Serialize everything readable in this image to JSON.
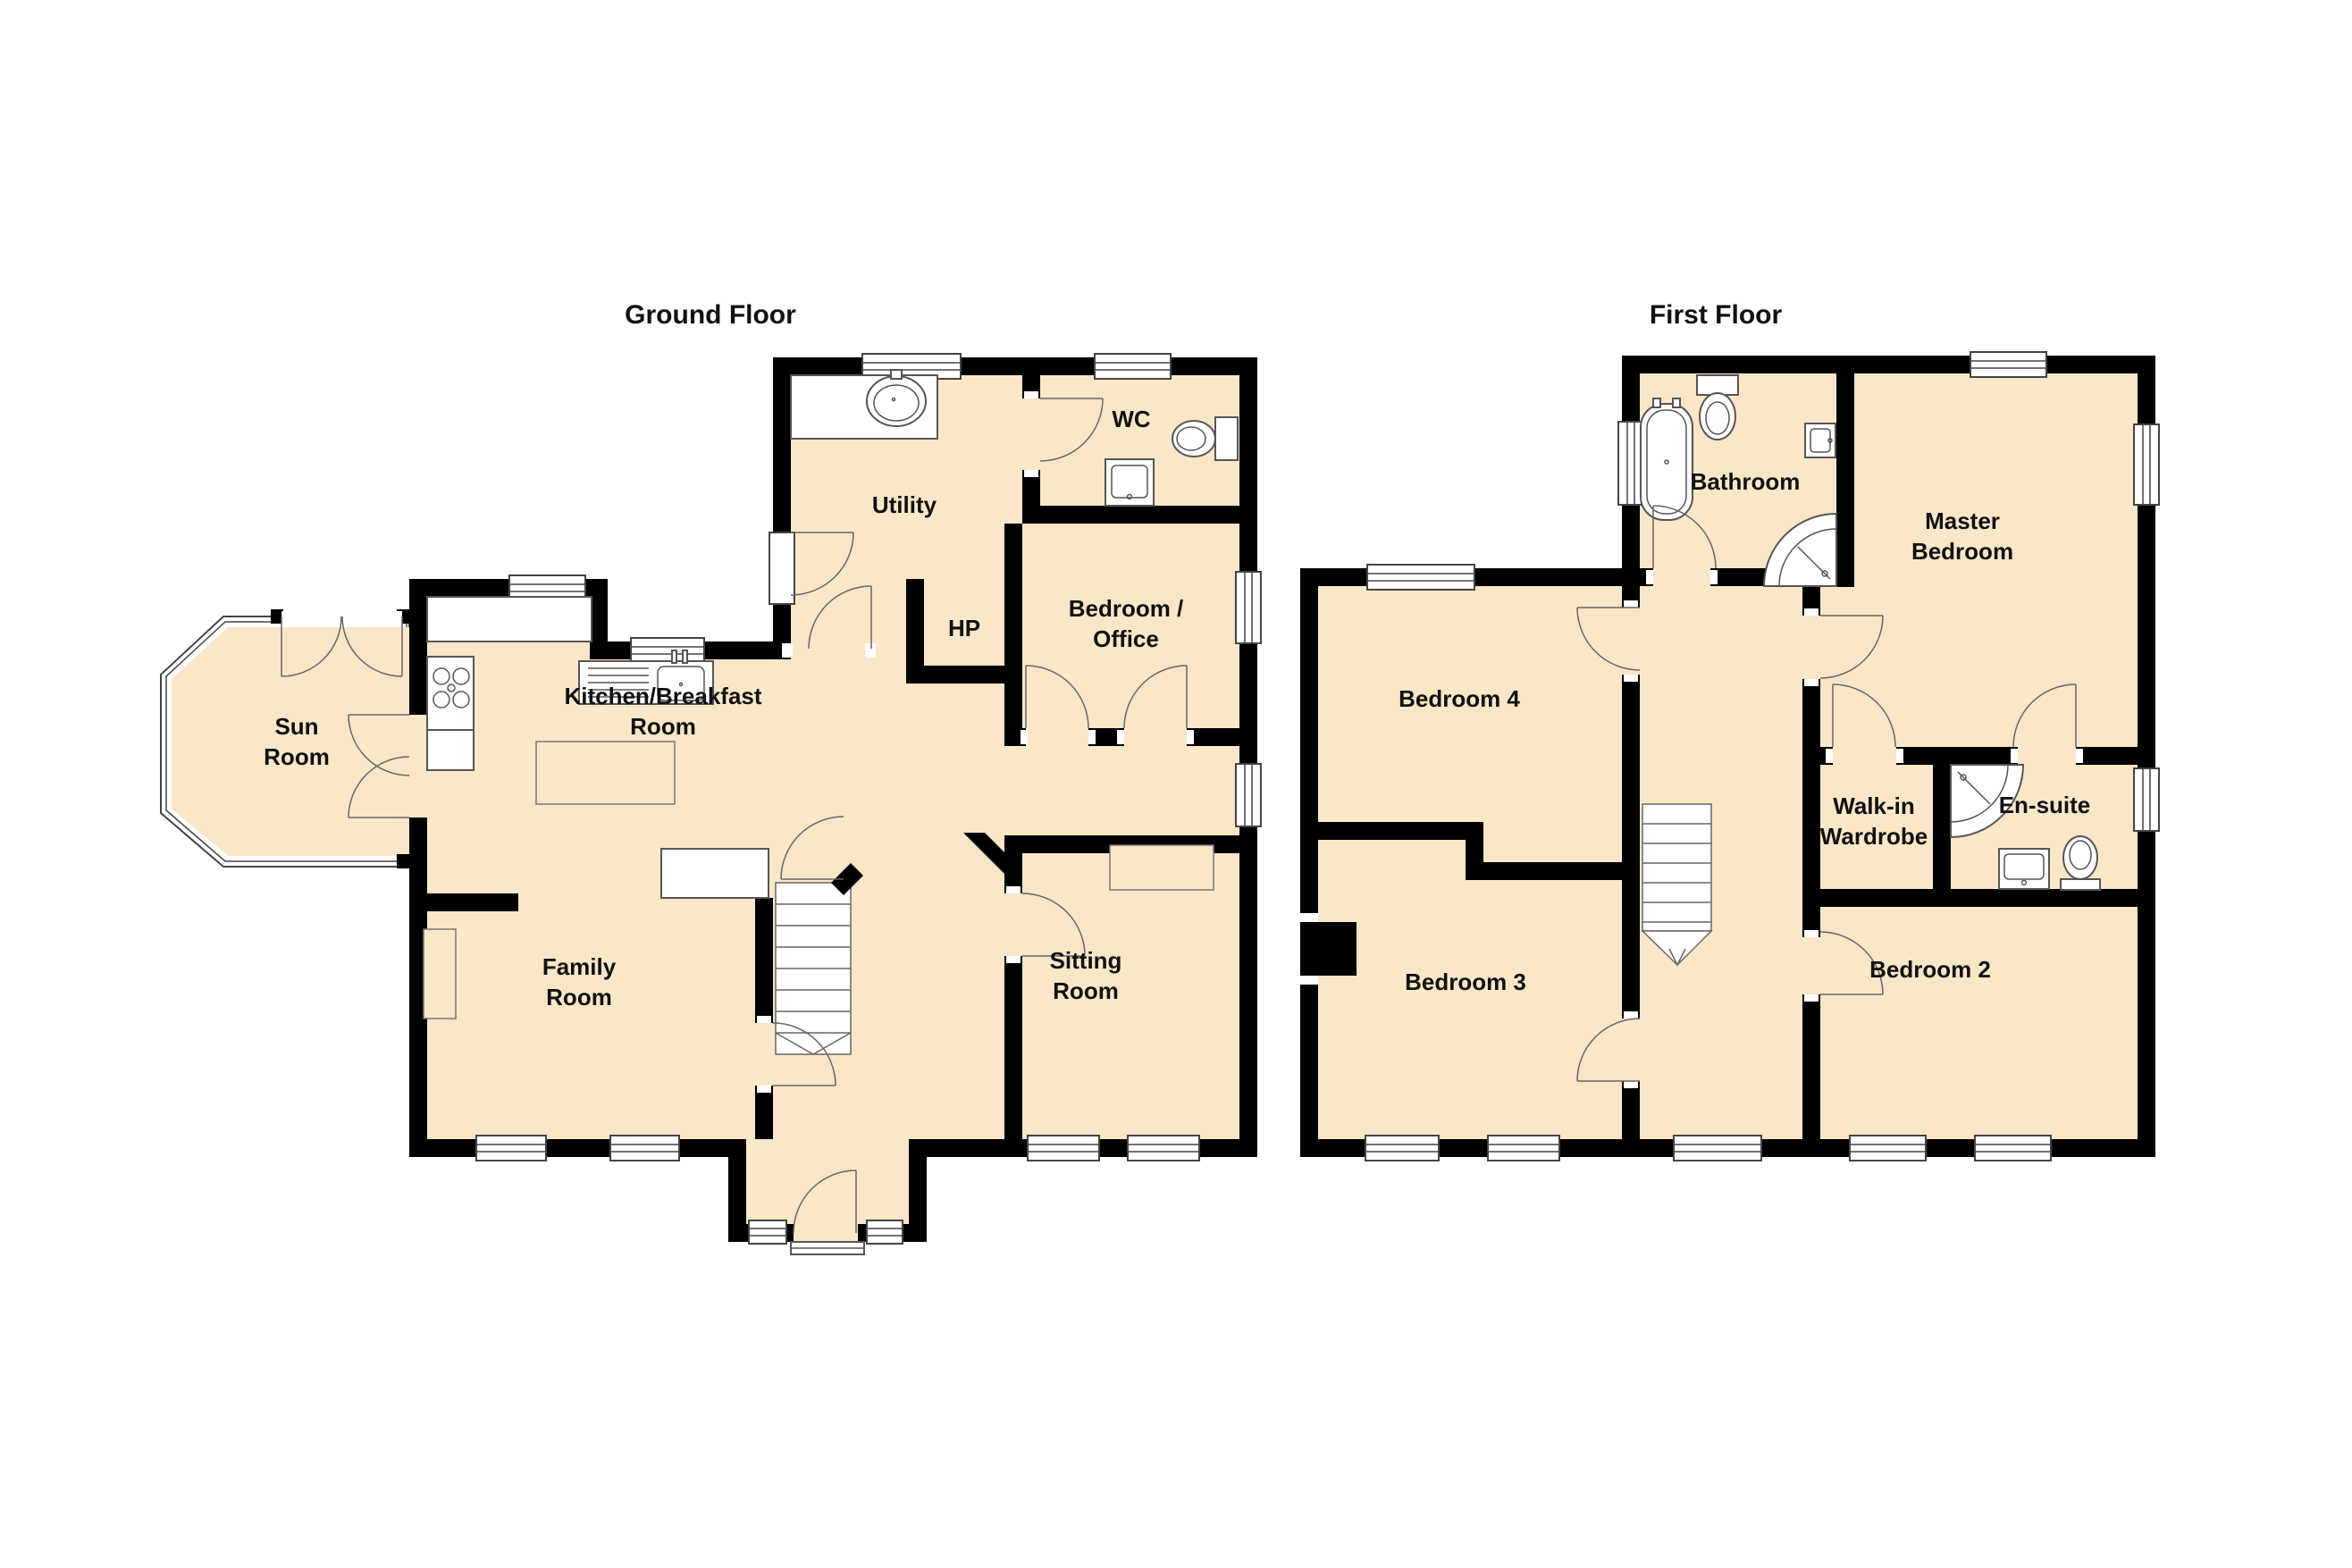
{
  "ground_floor": {
    "title": "Ground Floor",
    "rooms": {
      "sun_room": {
        "label": "Sun Room",
        "lines": [
          "Sun",
          "Room"
        ]
      },
      "kitchen_breakfast_room": {
        "label": "Kitchen/Breakfast Room",
        "lines": [
          "Kitchen/Breakfast",
          "Room"
        ]
      },
      "utility": {
        "label": "Utility",
        "lines": [
          "Utility"
        ]
      },
      "wc": {
        "label": "WC",
        "lines": [
          "WC"
        ]
      },
      "hp": {
        "label": "HP",
        "lines": [
          "HP"
        ]
      },
      "bedroom_office": {
        "label": "Bedroom / Office",
        "lines": [
          "Bedroom /",
          "Office"
        ]
      },
      "family_room": {
        "label": "Family Room",
        "lines": [
          "Family",
          "Room"
        ]
      },
      "sitting_room": {
        "label": "Sitting Room",
        "lines": [
          "Sitting",
          "Room"
        ]
      }
    }
  },
  "first_floor": {
    "title": "First Floor",
    "rooms": {
      "bathroom": {
        "label": "Bathroom",
        "lines": [
          "Bathroom"
        ]
      },
      "master_bedroom": {
        "label": "Master Bedroom",
        "lines": [
          "Master",
          "Bedroom"
        ]
      },
      "bedroom_4": {
        "label": "Bedroom 4",
        "lines": [
          "Bedroom 4"
        ]
      },
      "walk_in_wardrobe": {
        "label": "Walk-in Wardrobe",
        "lines": [
          "Walk-in",
          "Wardrobe"
        ]
      },
      "en_suite": {
        "label": "En-suite",
        "lines": [
          "En-suite"
        ]
      },
      "bedroom_3": {
        "label": "Bedroom 3",
        "lines": [
          "Bedroom 3"
        ]
      },
      "bedroom_2": {
        "label": "Bedroom 2",
        "lines": [
          "Bedroom 2"
        ]
      }
    }
  },
  "fixtures": {
    "ground": [
      "utility-sink",
      "wc-toilet",
      "wc-basin",
      "kitchen-sink",
      "stove-hob",
      "kitchen-island",
      "kitchen-peninsula",
      "staircase",
      "fireplace",
      "chimney-breast",
      "front-door-step",
      "bay-window",
      "french-doors"
    ],
    "first": [
      "bathtub",
      "toilet",
      "wash-basin",
      "shower",
      "staircase",
      "en-suite-shower",
      "en-suite-basin",
      "en-suite-toilet",
      "chimney-breast"
    ]
  },
  "colors": {
    "floor_fill": "#FAE7C8",
    "wall": "#000000",
    "fixture_outline": "#555555",
    "label_text": "#111111",
    "background": "#FFFFFF"
  }
}
